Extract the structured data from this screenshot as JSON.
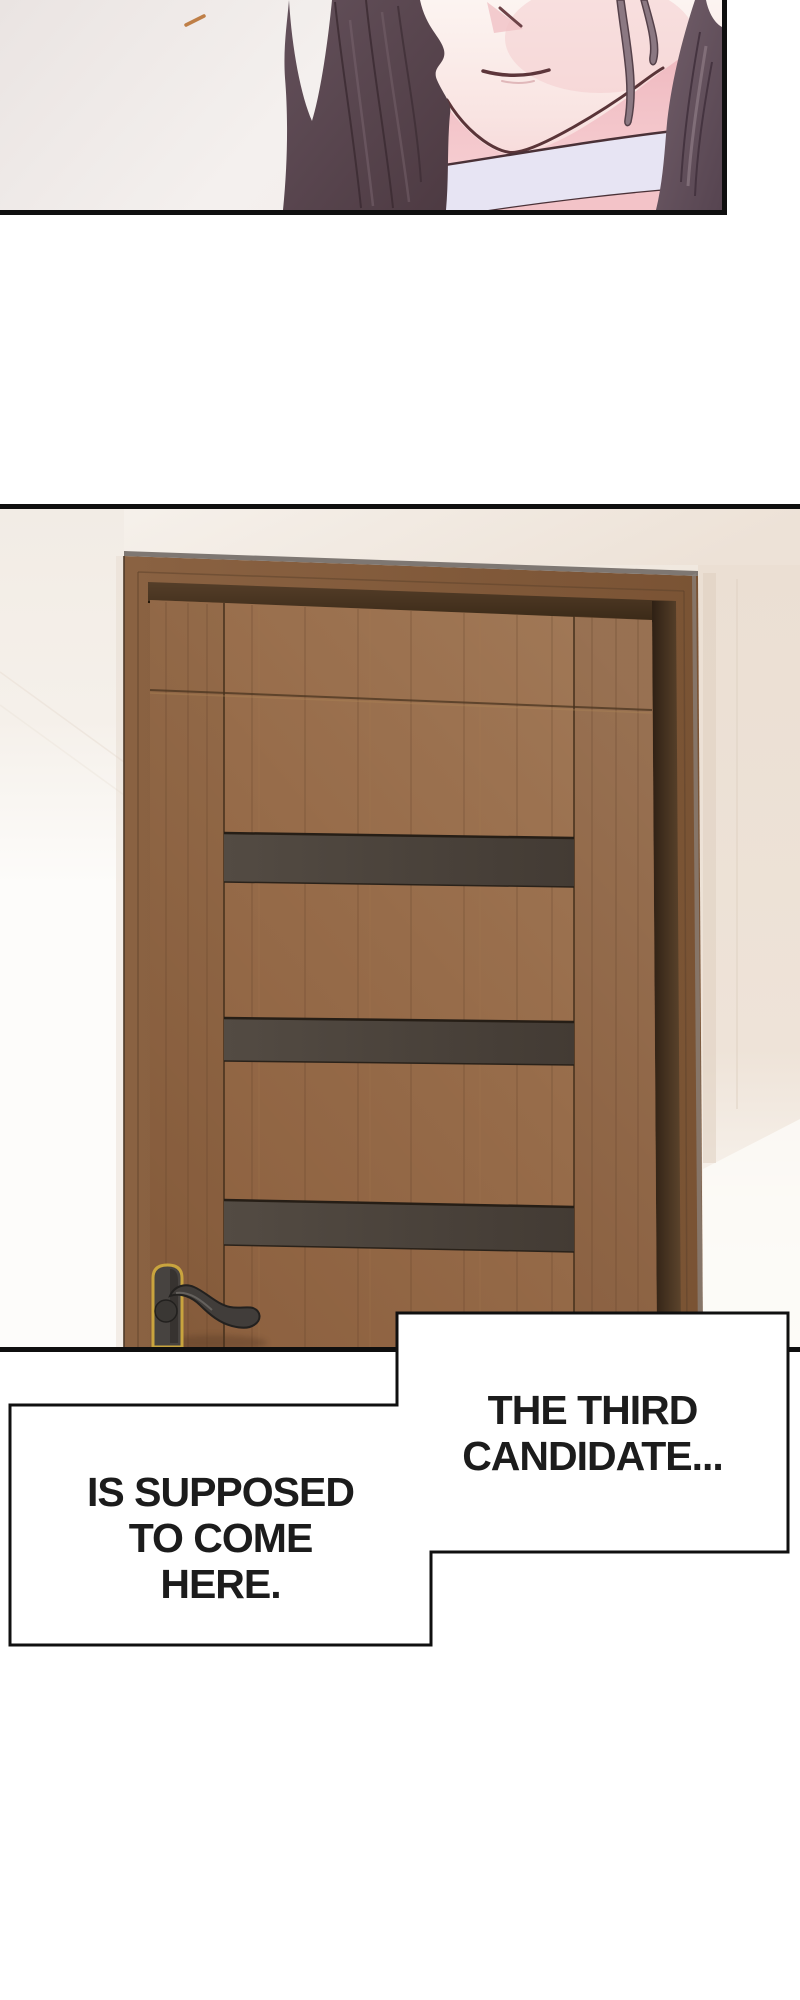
{
  "page": {
    "kind": "webtoon-comic-page",
    "background": "#ffffff"
  },
  "panels": [
    {
      "id": "closeup",
      "description": "Close-up of the lower half of a woman's face: dark plum wavy hair, pale skin, small mouth, lavender choker around her neck, small orange speck on the light background"
    },
    {
      "id": "door",
      "description": "A brown wooden interior door with three dark horizontal inset stripes, a dark lever handle with a gold-trimmed backplate, seen slightly from the left against a beige wall"
    }
  ],
  "speech": {
    "right": {
      "lines": [
        "THE THIRD",
        "CANDIDATE..."
      ]
    },
    "left": {
      "lines": [
        "IS SUPPOSED",
        "TO COME",
        "HERE."
      ]
    }
  },
  "palette": {
    "panel_border": "#0f0f0f",
    "bubble_border": "#101010",
    "bubble_fill": "#ffffff",
    "text_color": "#1c1c1c",
    "background_panel1": "#f2eeec",
    "skin": "#fbf1ee",
    "blush_pink": "#f0bcc2",
    "hair_dark": "#4e3b43",
    "hair_light": "#8d7a84",
    "choker": "#e7e4f3",
    "wall_beige": "#f0e8df",
    "wall_light": "#fcfbf9",
    "door_wood": "#8b5f3e",
    "door_frame": "#845c3c",
    "door_recess": "#3d2b19",
    "door_stripe": "#4b433c",
    "handle_metal": "#413d3a",
    "handle_gold": "#c9a43e",
    "accent_speck": "#bf7f47"
  }
}
